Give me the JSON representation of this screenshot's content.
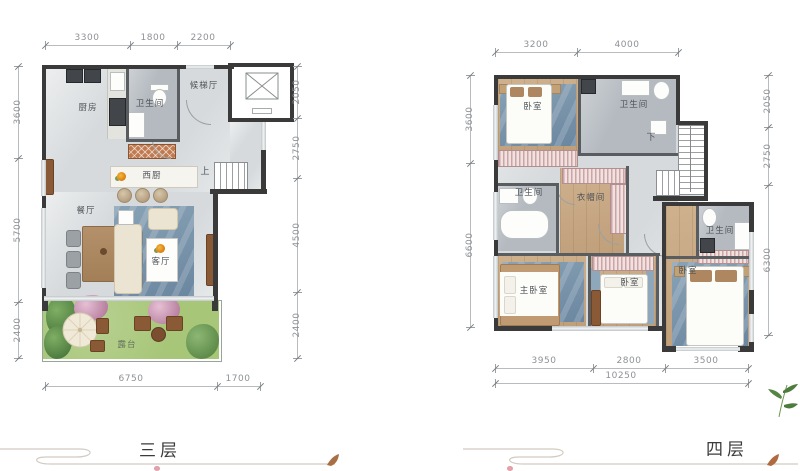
{
  "floor3": {
    "title": "三层",
    "dims": {
      "top": [
        "3300",
        "1800",
        "2200"
      ],
      "left": [
        "3600",
        "5700",
        "2400"
      ],
      "right": [
        "2050",
        "2750",
        "4500",
        "2400"
      ],
      "bottom": [
        "6750",
        "1700"
      ]
    },
    "rooms": {
      "kitchen": "厨房",
      "bathroom": "卫生间",
      "elevator_hall": "候梯厅",
      "west_kitchen": "西厨",
      "dining": "餐厅",
      "living": "客厅",
      "terrace": "露台",
      "stair": "上"
    }
  },
  "floor4": {
    "title": "四层",
    "dims": {
      "top": [
        "3200",
        "4000"
      ],
      "left": [
        "3600",
        "6600"
      ],
      "right": [
        "2050",
        "2750",
        "6300"
      ],
      "bottom": [
        "3950",
        "2800",
        "3500"
      ],
      "overall": "10250"
    },
    "rooms": {
      "bedroom_top": "卧室",
      "bathroom_top": "卫生间",
      "bathroom_mid": "卫生间",
      "closet": "衣帽间",
      "master_bedroom": "主卧室",
      "bedroom_mid": "卧室",
      "bedroom_right": "卧室",
      "bathroom_right": "卫生间",
      "stair": "下"
    }
  },
  "colors": {
    "wall": "#3a3a3a",
    "floor_marble": "#d6dadc",
    "floor_bath": "#b4bac0",
    "floor_wood": "#c9ab88",
    "rug_blue": "#7b95aa",
    "lawn_green": "#a7c678",
    "wardrobe_hatch": "#d9b0b0",
    "flower_accent": "#e8920f",
    "dim_text": "#8d9296"
  },
  "icons": {
    "elevator": "elevator-x-icon",
    "parasol": "parasol-icon",
    "leaf": "leaf-icon",
    "bamboo": "bamboo-icon",
    "flower": "flower-icon"
  }
}
